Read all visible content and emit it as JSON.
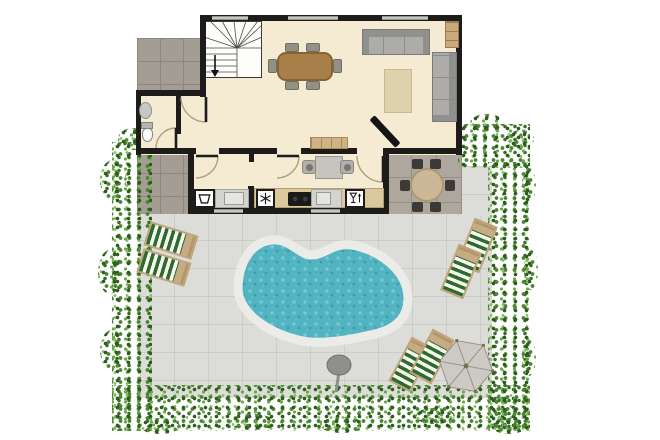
{
  "meta": {
    "description": "Residential floor plan with living room, kitchen, WC, staircase, outdoor dining patio, paved yard, kidney-shaped pool, sun loungers, parasol and hedges",
    "canvas": {
      "w": 660,
      "h": 440
    }
  },
  "palette": {
    "wall": "#1d1c1a",
    "floor": "#f4ebd2",
    "tile_light": "#dcdcd8",
    "tile_dark": "#a39d94",
    "tile_mid": "#ada79e",
    "pool_water": "#52b4c1",
    "pool_coping": "#ebebe7",
    "hedge_green": "#4a8531",
    "lounger_stripe": "#2e6b2e",
    "lounger_tan": "#c6ac83",
    "table_wood": "#a87f48"
  },
  "floorplan": {
    "items": [
      {
        "t": "ground",
        "cls": "tile-light",
        "name": "yard-paving",
        "r": [
          140,
          212,
          352,
          186
        ]
      },
      {
        "t": "ground",
        "cls": "tile-light",
        "name": "yard-paving-ne",
        "r": [
          458,
          166,
          34,
          50
        ]
      },
      {
        "t": "ground",
        "cls": "tile-dark",
        "name": "path-top-left",
        "r": [
          137,
          38,
          68,
          53
        ]
      },
      {
        "t": "ground",
        "cls": "tile-dark",
        "name": "path-left",
        "r": [
          137,
          150,
          55,
          64
        ]
      },
      {
        "t": "ground",
        "cls": "tile-mid",
        "name": "patio-dining",
        "r": [
          386,
          152,
          76,
          62
        ]
      },
      {
        "t": "hedge",
        "name": "hedge-left",
        "r": [
          112,
          142,
          40,
          289
        ]
      },
      {
        "t": "hedge",
        "name": "hedge-bottom",
        "r": [
          112,
          385,
          418,
          46
        ]
      },
      {
        "t": "hedge",
        "name": "hedge-right",
        "r": [
          488,
          162,
          42,
          269
        ]
      },
      {
        "t": "hedge",
        "name": "hedge-top-right",
        "r": [
          458,
          124,
          72,
          44
        ]
      },
      {
        "t": "hedge-blob",
        "name": "hedge-blob",
        "r": [
          100,
          160,
          26,
          40
        ]
      },
      {
        "t": "hedge-blob",
        "name": "hedge-blob",
        "r": [
          98,
          250,
          24,
          44
        ]
      },
      {
        "t": "hedge-blob",
        "name": "hedge-blob",
        "r": [
          100,
          330,
          24,
          40
        ]
      },
      {
        "t": "hedge-blob",
        "name": "hedge-blob",
        "r": [
          118,
          128,
          30,
          22
        ]
      },
      {
        "t": "hedge-blob",
        "name": "hedge-blob",
        "r": [
          140,
          418,
          40,
          16
        ]
      },
      {
        "t": "hedge-blob",
        "name": "hedge-blob",
        "r": [
          230,
          414,
          44,
          16
        ]
      },
      {
        "t": "hedge-blob",
        "name": "hedge-blob",
        "r": [
          320,
          417,
          44,
          16
        ]
      },
      {
        "t": "hedge-blob",
        "name": "hedge-blob",
        "r": [
          415,
          408,
          40,
          16
        ]
      },
      {
        "t": "hedge-blob",
        "name": "hedge-blob",
        "r": [
          492,
          418,
          34,
          16
        ]
      },
      {
        "t": "hedge-blob",
        "name": "hedge-blob",
        "r": [
          524,
          250,
          14,
          40
        ]
      },
      {
        "t": "hedge-blob",
        "name": "hedge-blob",
        "r": [
          522,
          340,
          14,
          36
        ]
      },
      {
        "t": "hedge-blob",
        "name": "hedge-blob",
        "r": [
          470,
          114,
          34,
          18
        ]
      },
      {
        "t": "hedge-blob",
        "name": "hedge-blob",
        "r": [
          508,
          130,
          26,
          18
        ]
      },
      {
        "t": "hedge-blob",
        "name": "hedge-blob",
        "r": [
          522,
          168,
          14,
          34
        ]
      },
      {
        "t": "floor",
        "name": "room-living",
        "r": [
          200,
          15,
          262,
          140
        ]
      },
      {
        "t": "floor",
        "name": "room-hall-wc",
        "r": [
          136,
          90,
          70,
          65
        ]
      },
      {
        "t": "floor",
        "name": "room-kitchen",
        "r": [
          188,
          148,
          201,
          66
        ]
      },
      {
        "t": "stairs",
        "name": "staircase",
        "r": [
          204,
          21,
          58,
          57
        ]
      },
      {
        "t": "wall",
        "name": "wall-top",
        "r": [
          200,
          15,
          262,
          6
        ]
      },
      {
        "t": "wall",
        "name": "wall-right",
        "r": [
          456,
          15,
          6,
          140
        ]
      },
      {
        "t": "wall",
        "name": "wall-stairs-left",
        "r": [
          200,
          15,
          6,
          82
        ]
      },
      {
        "t": "wall",
        "name": "wall-hall-top",
        "r": [
          136,
          90,
          70,
          6
        ]
      },
      {
        "t": "wall",
        "name": "wall-wc-left",
        "r": [
          136,
          90,
          5,
          65
        ]
      },
      {
        "t": "wall",
        "name": "wall-mid-1",
        "r": [
          136,
          148,
          60,
          6
        ]
      },
      {
        "t": "wall",
        "name": "wall-mid-2",
        "r": [
          219,
          148,
          58,
          6
        ]
      },
      {
        "t": "wall",
        "name": "wall-mid-3",
        "r": [
          301,
          148,
          56,
          6
        ]
      },
      {
        "t": "wall",
        "name": "wall-mid-4",
        "r": [
          383,
          148,
          79,
          6
        ]
      },
      {
        "t": "wall",
        "name": "wall-kitchen-left",
        "r": [
          188,
          154,
          6,
          60
        ]
      },
      {
        "t": "wall",
        "name": "wall-kitchen-bottom",
        "r": [
          188,
          208,
          201,
          6
        ]
      },
      {
        "t": "wall",
        "name": "wall-kitchen-right",
        "r": [
          383,
          154,
          6,
          60
        ]
      },
      {
        "t": "wall",
        "name": "wall-wc-divider",
        "r": [
          176,
          96,
          5,
          38
        ]
      },
      {
        "t": "wall",
        "name": "wall-kitchen-divider",
        "r": [
          248,
          186,
          6,
          26
        ]
      },
      {
        "t": "wall",
        "name": "wall-kitchen-divider-stub",
        "r": [
          249,
          154,
          5,
          8
        ]
      },
      {
        "t": "window",
        "name": "window",
        "r": [
          212,
          16,
          36,
          4
        ]
      },
      {
        "t": "window",
        "name": "window",
        "r": [
          288,
          16,
          50,
          4
        ]
      },
      {
        "t": "window",
        "name": "window",
        "r": [
          382,
          16,
          46,
          4
        ]
      },
      {
        "t": "window",
        "name": "window",
        "r": [
          214,
          209,
          29,
          4
        ]
      },
      {
        "t": "window",
        "name": "window",
        "r": [
          311,
          209,
          29,
          4
        ]
      },
      {
        "t": "door",
        "name": "door-hall",
        "h": [
          206,
          97
        ],
        "rad": 25,
        "a0": 90,
        "a1": 180
      },
      {
        "t": "door",
        "name": "door-wc",
        "h": [
          176,
          148
        ],
        "rad": 20,
        "a0": 270,
        "a1": 180
      },
      {
        "t": "door",
        "name": "door-laundry",
        "h": [
          196,
          156
        ],
        "rad": 22,
        "a0": 0,
        "a1": 90
      },
      {
        "t": "door",
        "name": "door-kitchen-left",
        "h": [
          277,
          156
        ],
        "rad": 22,
        "a0": 0,
        "a1": 90
      },
      {
        "t": "door",
        "name": "door-kitchen-right",
        "h": [
          383,
          156
        ],
        "rad": 26,
        "a0": 90,
        "a1": 180
      },
      {
        "t": "rect",
        "cls": "dining-table",
        "name": "dining-table",
        "r": [
          277,
          52,
          56,
          29
        ]
      },
      {
        "t": "rect",
        "cls": "chair",
        "name": "dining-chair",
        "r": [
          285,
          43,
          14,
          9
        ]
      },
      {
        "t": "rect",
        "cls": "chair",
        "name": "dining-chair",
        "r": [
          306,
          43,
          14,
          9
        ]
      },
      {
        "t": "rect",
        "cls": "chair",
        "name": "dining-chair",
        "r": [
          285,
          81,
          14,
          9
        ]
      },
      {
        "t": "rect",
        "cls": "chair",
        "name": "dining-chair",
        "r": [
          306,
          81,
          14,
          9
        ]
      },
      {
        "t": "rect",
        "cls": "chair",
        "name": "dining-chair",
        "r": [
          268,
          59,
          9,
          14
        ]
      },
      {
        "t": "rect",
        "cls": "chair",
        "name": "dining-chair",
        "r": [
          333,
          59,
          9,
          14
        ]
      },
      {
        "t": "rect",
        "cls": "sofa-h",
        "name": "sofa",
        "r": [
          362,
          29,
          68,
          26
        ]
      },
      {
        "t": "rect",
        "cls": "sofa-v",
        "name": "sofa-2",
        "r": [
          432,
          52,
          25,
          70
        ]
      },
      {
        "t": "rect",
        "cls": "rug",
        "name": "rug",
        "r": [
          384,
          69,
          28,
          44
        ]
      },
      {
        "t": "rect",
        "cls": "shelf",
        "name": "corner-shelf",
        "r": [
          445,
          21,
          14,
          27
        ]
      },
      {
        "t": "rect",
        "cls": "sideboard",
        "name": "sideboard",
        "r": [
          310,
          137,
          38,
          12
        ]
      },
      {
        "t": "rect",
        "cls": "tv",
        "name": "tv",
        "r": [
          366,
          128,
          38,
          7
        ],
        "rot": 47
      },
      {
        "t": "rect",
        "cls": "island-table",
        "name": "kitchen-table",
        "r": [
          315,
          156,
          28,
          23
        ]
      },
      {
        "t": "rect",
        "cls": "island-chair",
        "name": "kitchen-chair",
        "r": [
          302,
          160,
          14,
          14
        ]
      },
      {
        "t": "rect",
        "cls": "island-chair",
        "name": "kitchen-chair",
        "r": [
          340,
          160,
          14,
          14
        ]
      },
      {
        "t": "rect",
        "cls": "toilet-tank",
        "name": "toilet-tank",
        "r": [
          141,
          122,
          12,
          7
        ]
      },
      {
        "t": "rect",
        "cls": "toilet-bowl",
        "name": "toilet",
        "r": [
          142,
          128,
          11,
          14
        ]
      },
      {
        "t": "rect",
        "cls": "wash-basin",
        "name": "wash-basin",
        "r": [
          139,
          102,
          13,
          17
        ]
      },
      {
        "t": "appliance",
        "glyph": "washer",
        "name": "washing-machine",
        "r": [
          194,
          189,
          21,
          19
        ]
      },
      {
        "t": "rect",
        "cls": "counter-gray",
        "name": "laundry-counter",
        "r": [
          215,
          189,
          34,
          19
        ]
      },
      {
        "t": "rect",
        "cls": "sink-basin",
        "name": "laundry-sink",
        "r": [
          224,
          192,
          20,
          13
        ]
      },
      {
        "t": "rect",
        "cls": "counter-wood",
        "name": "kitchen-counter",
        "r": [
          254,
          188,
          130,
          20
        ]
      },
      {
        "t": "appliance",
        "glyph": "snow",
        "name": "freezer",
        "r": [
          256,
          189,
          19,
          19
        ]
      },
      {
        "t": "rect",
        "cls": "stove",
        "name": "stove",
        "r": [
          288,
          192,
          24,
          14
        ]
      },
      {
        "t": "rect",
        "cls": "counter-gray",
        "name": "sink-counter",
        "r": [
          311,
          189,
          31,
          19
        ]
      },
      {
        "t": "rect",
        "cls": "sink-basin",
        "name": "kitchen-sink",
        "r": [
          316,
          192,
          15,
          13
        ]
      },
      {
        "t": "appliance",
        "glyph": "dish",
        "name": "dishwasher",
        "r": [
          345,
          189,
          20,
          19
        ]
      },
      {
        "t": "pool",
        "name": "swimming-pool",
        "r": [
          225,
          222,
          200,
          132
        ]
      },
      {
        "t": "rect",
        "cls": "round-table",
        "name": "patio-table",
        "r": [
          410,
          168,
          34,
          34
        ]
      },
      {
        "t": "rect",
        "cls": "chair-dark",
        "name": "patio-chair",
        "r": [
          412,
          159,
          11,
          10
        ]
      },
      {
        "t": "rect",
        "cls": "chair-dark",
        "name": "patio-chair",
        "r": [
          430,
          159,
          11,
          10
        ]
      },
      {
        "t": "rect",
        "cls": "chair-dark",
        "name": "patio-chair",
        "r": [
          400,
          180,
          10,
          11
        ]
      },
      {
        "t": "rect",
        "cls": "chair-dark",
        "name": "patio-chair",
        "r": [
          445,
          180,
          10,
          11
        ]
      },
      {
        "t": "rect",
        "cls": "chair-dark",
        "name": "patio-chair",
        "r": [
          412,
          202,
          11,
          10
        ]
      },
      {
        "t": "rect",
        "cls": "chair-dark",
        "name": "patio-chair",
        "r": [
          430,
          202,
          11,
          10
        ]
      },
      {
        "t": "rect",
        "cls": "lounger",
        "name": "sun-lounger",
        "r": [
          146,
          228,
          50,
          25
        ],
        "rot": 17
      },
      {
        "t": "rect",
        "cls": "lounger",
        "name": "sun-lounger",
        "r": [
          139,
          255,
          50,
          25
        ],
        "rot": 17
      },
      {
        "t": "rect",
        "cls": "lounger",
        "name": "sun-lounger",
        "r": [
          452,
          233,
          50,
          25
        ],
        "rot": -68
      },
      {
        "t": "rect",
        "cls": "lounger",
        "name": "sun-lounger",
        "r": [
          436,
          259,
          50,
          25
        ],
        "rot": -68
      },
      {
        "t": "rect",
        "cls": "lounger",
        "name": "sun-lounger",
        "r": [
          386,
          352,
          50,
          25
        ],
        "rot": -62
      },
      {
        "t": "rect",
        "cls": "lounger",
        "name": "sun-lounger",
        "r": [
          407,
          344,
          50,
          25
        ],
        "rot": -62
      },
      {
        "t": "umbrella",
        "name": "parasol",
        "r": [
          437,
          337,
          58,
          58
        ]
      },
      {
        "t": "shower",
        "name": "outdoor-shower",
        "r": [
          325,
          354,
          28,
          40
        ]
      }
    ]
  }
}
